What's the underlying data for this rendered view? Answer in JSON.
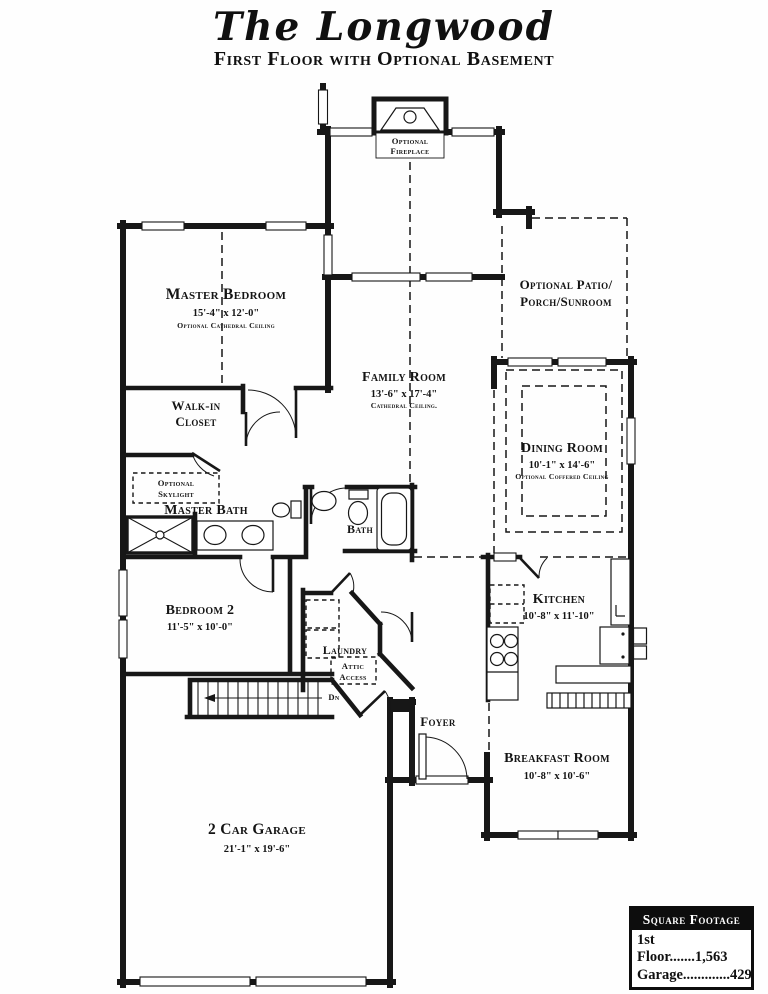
{
  "header": {
    "title": "The Longwood",
    "subtitle": "First Floor with Optional Basement"
  },
  "rooms": {
    "optional_fireplace": {
      "line1": "Optional",
      "line2": "Fireplace"
    },
    "optional_patio": {
      "line1": "Optional Patio/",
      "line2": "Porch/Sunroom"
    },
    "master_bedroom": {
      "name": "Master Bedroom",
      "dims": "15'-4\" x 12'-0\"",
      "note": "Optional Cathedral Ceiling"
    },
    "family_room": {
      "name": "Family Room",
      "dims": "13'-6\" x 17'-4\"",
      "note": "Cathedral Ceiling."
    },
    "dining_room": {
      "name": "Dining Room",
      "dims": "10'-1\" x 14'-6\"",
      "note": "Optional Coffered Ceiling"
    },
    "walk_in_closet": {
      "line1": "Walk-in",
      "line2": "Closet"
    },
    "optional_skylight": {
      "line1": "Optional",
      "line2": "Skylight"
    },
    "master_bath": {
      "name": "Master Bath"
    },
    "bath": {
      "name": "Bath"
    },
    "bedroom_2": {
      "name": "Bedroom 2",
      "dims": "11'-5\" x 10'-0\""
    },
    "laundry": {
      "name": "Laundry"
    },
    "attic_access": {
      "line1": "Attic",
      "line2": "Access"
    },
    "stairs": {
      "dn": "Dn"
    },
    "kitchen": {
      "name": "Kitchen",
      "dims": "10'-8\" x 11'-10\""
    },
    "foyer": {
      "name": "Foyer"
    },
    "breakfast_room": {
      "name": "Breakfast Room",
      "dims": "10'-8\" x 10'-6\""
    },
    "garage": {
      "name": "2 Car Garage",
      "dims": "21'-1\" x 19'-6\""
    }
  },
  "square_footage": {
    "header": "Square Footage",
    "rows": [
      {
        "text": "1st Floor.......1,563"
      },
      {
        "text": "Garage.............429"
      }
    ]
  },
  "colors": {
    "ink": "#171717",
    "paper": "#ffffff"
  }
}
